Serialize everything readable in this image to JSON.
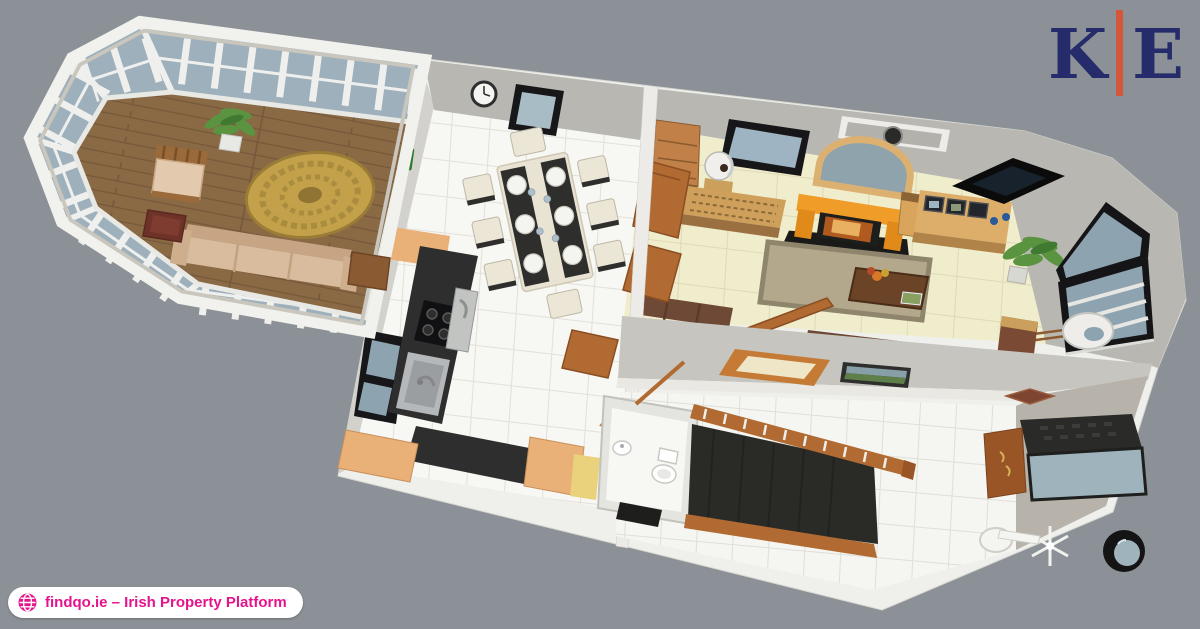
{
  "page": {
    "width": 1200,
    "height": 629,
    "background_color": "#8b9196"
  },
  "branding": {
    "logo": {
      "letter_left": "K",
      "letter_right": "E",
      "letter_color": "#262c6b",
      "divider_color": "#d4573a"
    },
    "badge": {
      "label": "findqo.ie – Irish Property Platform",
      "text_color": "#e5148c",
      "background_color": "#ffffff",
      "icon": "globe-icon"
    }
  },
  "floorplan": {
    "view": "3D dollhouse floor-plan render of a single-storey home, seen from above at an angle",
    "colors": {
      "canvas": "#8b9196",
      "outer_wall": "#efefec",
      "inner_wall": "#b8b7b2",
      "glass": "#9db0bb",
      "window_glass": "#8ea3b0",
      "window_frame": "#17171a",
      "wood_floor": "#8a6a45",
      "tile_white": "#f7f7f3",
      "tile_cream": "#f0edcc",
      "vestibule_floor": "#b7b3aa",
      "counter_tan": "#e9b077",
      "counter_black": "#2e2e2e",
      "wood_trim": "#b06a32",
      "stairs": "#2a2a27",
      "fireplace_orange": "#f09c28",
      "rug_gold": "#c2a14a",
      "rug_living": "#b3a78c",
      "sofa_beige": "#d9bb9e",
      "sofa_brown": "#6e4936",
      "plant": "#5a9440"
    },
    "rooms": [
      {
        "id": "conservatory",
        "furniture": [
          "glazed-windows",
          "wood-floor",
          "round-rug",
          "sofa",
          "armchair",
          "ottoman",
          "potted-plant",
          "sideboard"
        ]
      },
      {
        "id": "kitchen-dining",
        "furniture": [
          "dining-table",
          "chairs",
          "place-settings",
          "l-shaped-counter",
          "hob",
          "oven",
          "sink",
          "window",
          "wall-clock"
        ]
      },
      {
        "id": "living-room",
        "furniture": [
          "fireplace",
          "arched-mirror",
          "tv",
          "media-cabinet",
          "dresser",
          "globe-lamp",
          "sideboard",
          "rug",
          "coffee-table",
          "corner-sofa",
          "bench",
          "potted-plant",
          "corner-window",
          "ring-light",
          "cabinet"
        ]
      },
      {
        "id": "hallway",
        "furniture": [
          "staircase",
          "banister",
          "hall-table",
          "wall-painting",
          "stairwell-frame",
          "front-door",
          "door-mat",
          "porthole-mirror",
          "coat-stand",
          "wash-basin"
        ]
      },
      {
        "id": "wc",
        "furniture": [
          "toilet",
          "hand-basin"
        ]
      }
    ]
  }
}
